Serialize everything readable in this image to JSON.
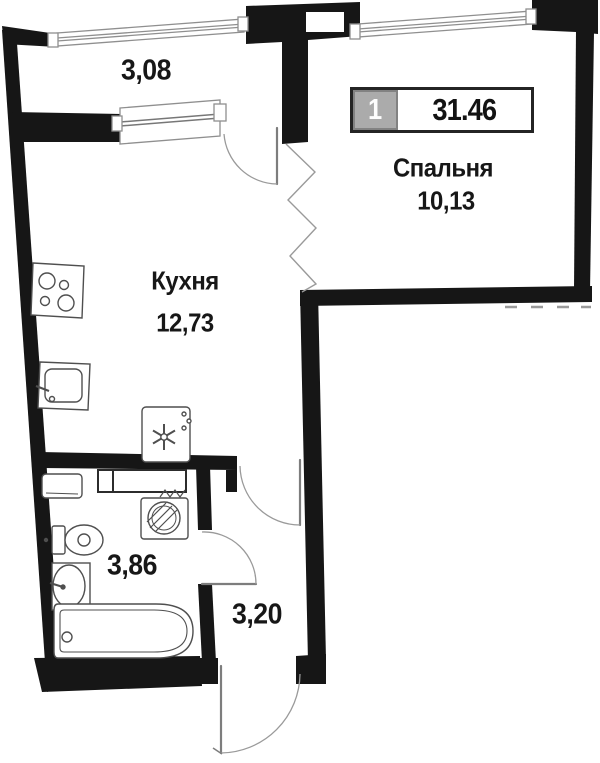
{
  "plan": {
    "badge": {
      "rooms": "1",
      "total_area": "31.46"
    },
    "rooms": {
      "balcony": {
        "area": "3,08"
      },
      "bedroom": {
        "name": "Спальня",
        "area": "10,13"
      },
      "kitchen": {
        "name": "Кухня",
        "area": "12,73"
      },
      "bathroom": {
        "area": "3,86"
      },
      "hallway": {
        "area": "3,20"
      }
    },
    "icons": [
      "stove-icon",
      "kitchen-sink-icon",
      "refrigerator-icon",
      "vent-duct-icon",
      "bathroom-cabinet-icon",
      "washing-machine-icon",
      "toilet-icon",
      "washbasin-icon",
      "bathtub-icon",
      "door-arc",
      "window"
    ],
    "colors": {
      "wall": "#161616",
      "fixture_line": "#4f4f4f",
      "light_line": "#999999",
      "badge_gray": "#ababab",
      "text": "#171717"
    }
  }
}
